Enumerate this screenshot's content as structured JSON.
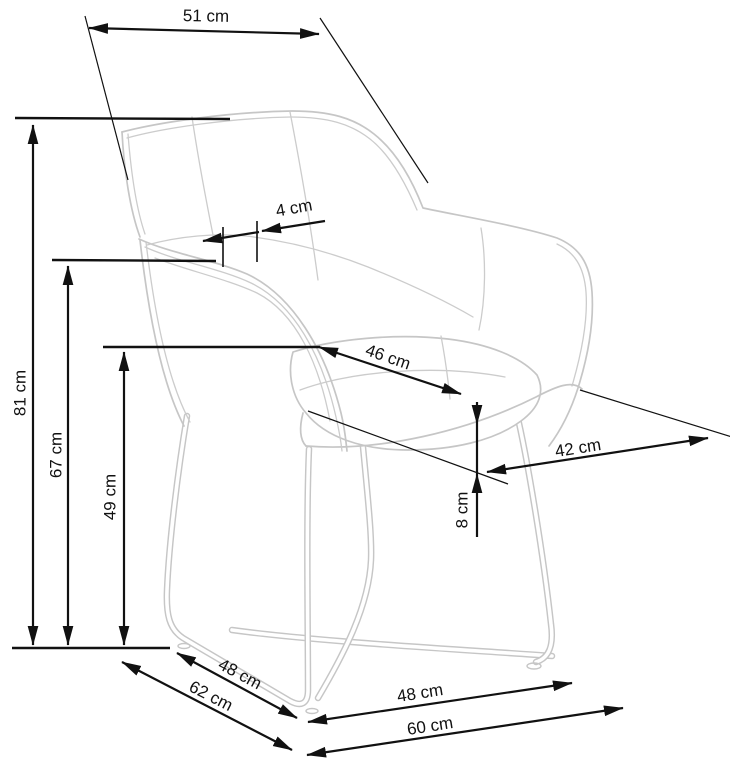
{
  "diagram": {
    "type": "furniture-dimension-drawing",
    "subject": "upholstered armchair with metal sled base",
    "unit": "cm",
    "dimensions": {
      "backrest_top_width": {
        "value": 51,
        "label": "51 cm"
      },
      "armrest_pad_width": {
        "value": 4,
        "label": "4 cm"
      },
      "total_height": {
        "value": 81,
        "label": "81 cm"
      },
      "armrest_height": {
        "value": 67,
        "label": "67 cm"
      },
      "seat_height": {
        "value": 49,
        "label": "49 cm"
      },
      "seat_width": {
        "value": 46,
        "label": "46 cm"
      },
      "seat_depth": {
        "value": 42,
        "label": "42 cm"
      },
      "cushion_thickness": {
        "value": 8,
        "label": "8 cm"
      },
      "base_side_length": {
        "value": 48,
        "label": "48 cm"
      },
      "base_depth": {
        "value": 62,
        "label": "62 cm"
      },
      "base_front_length": {
        "value": 48,
        "label": "48 cm"
      },
      "total_width": {
        "value": 60,
        "label": "60 cm"
      }
    },
    "colors": {
      "dimension_lines": "#111111",
      "chair_outline": "#c6c6c6",
      "background": "#ffffff"
    }
  }
}
